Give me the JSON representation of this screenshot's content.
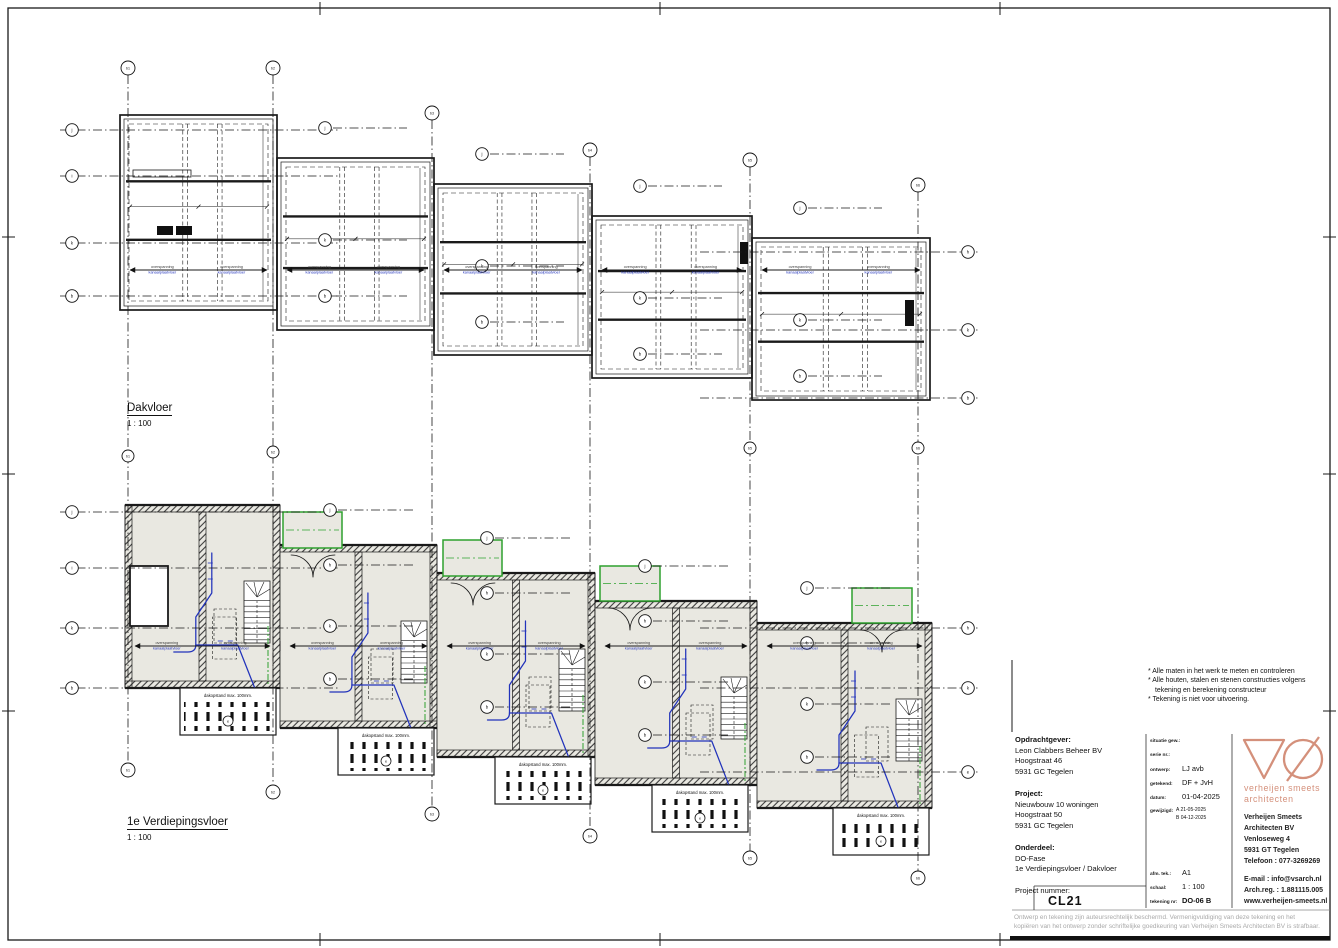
{
  "plans": {
    "top": {
      "title": "Dakvloer",
      "scale": "1 : 100"
    },
    "bottom": {
      "title": "1e Verdiepingsvloer",
      "scale": "1 : 100"
    }
  },
  "annotations": {
    "span_line1": "overspanning",
    "span_line2": "kanaalplaatvloer",
    "balcony_label": "dakopstand max. 100mm.",
    "notes": [
      "* Alle maten in het werk te meten en controleren",
      "* Alle houten, stalen en stenen constructies volgens",
      "tekening en berekening constructeur",
      "* Tekening is niet voor uitvoering."
    ]
  },
  "grid_labels": {
    "col_top": [
      "b1",
      "b2",
      "b3",
      "b4",
      "b5",
      "b6"
    ],
    "col_mid": [
      "b1",
      "b2",
      "b5",
      "b6"
    ],
    "col_bottom": [
      "b1",
      "b2",
      "b3",
      "b4",
      "b5",
      "b6"
    ],
    "rows_left_top": [
      "j",
      "i",
      "k",
      "b"
    ],
    "rows_right_top": [
      "h",
      "k",
      "b"
    ],
    "rows_left_bottom": [
      "j",
      "i",
      "k",
      "b"
    ],
    "rows_right_bottom": [
      "h",
      "k",
      "e"
    ],
    "unit_rows_top": [
      "j",
      "k",
      "b"
    ],
    "unit_rows_bottom": [
      "j",
      "h",
      "k",
      "b"
    ],
    "balcony_bubble": "e"
  },
  "title_block": {
    "client_heading": "Opdrachtgever:",
    "client_line1": "Leon Clabbers Beheer BV",
    "client_line2": "Hoogstraat 46",
    "client_line3": "5931 GC  Tegelen",
    "project_heading": "Project:",
    "project_line1": "Nieuwbouw 10 woningen",
    "project_line2": "Hoogstraat 50",
    "project_line3": "5931 GC  Tegelen",
    "part_heading": "Onderdeel:",
    "part_line1": "DO-Fase",
    "part_line2": "1e Verdiepingsvloer / Dakvloer",
    "number_heading": "Project nummer:",
    "number": "CL21",
    "meta": {
      "status_label": "situatie gew.:",
      "serie_label": "serie nr.:",
      "ontwerp_label": "ontwerp:",
      "ontwerp": "LJ avb",
      "getekend_label": "getekend:",
      "getekend": "DF + JvH",
      "datum_label": "datum:",
      "datum": "01-04-2025",
      "gewijzigd_label": "gewijzigd:",
      "rev_a": "A   21-05-2025",
      "rev_b": "B   04-12-2025",
      "formaat_label": "afm. tek.:",
      "formaat": "A1",
      "schaal_label": "schaal:",
      "schaal": "1 : 100",
      "tekening_label": "tekening nr:",
      "tekening": "DO-06 B"
    },
    "firm": {
      "caption1": "verheijen smeets",
      "caption2": "architecten",
      "addr1": "Verheijen Smeets",
      "addr2": "Architecten BV",
      "addr3": "Venloseweg 4",
      "addr4": "5931 GT  Tegelen",
      "addr5": "Telefoon    : 077-3269269",
      "contact1": "E-mail        : info@vsarch.nl",
      "contact2": "Arch.reg.   : 1.881115.005",
      "contact3": "www.verheijen-smeets.nl"
    },
    "disclaimer1": "Ontwerp en tekening zijn auteursrechtelijk beschermd. Vermenigvuldiging van deze tekening en het",
    "disclaimer2": "kopiëren van het ontwerp zonder schriftelijke goedkeuring van Verheijen Smeets Architecten BV is strafbaar."
  },
  "colors": {
    "line": "#1a1a1a",
    "coral": "#d4907b",
    "blue": "#2233bb",
    "green": "#2ea12e",
    "floor": "#e9e8e1"
  }
}
